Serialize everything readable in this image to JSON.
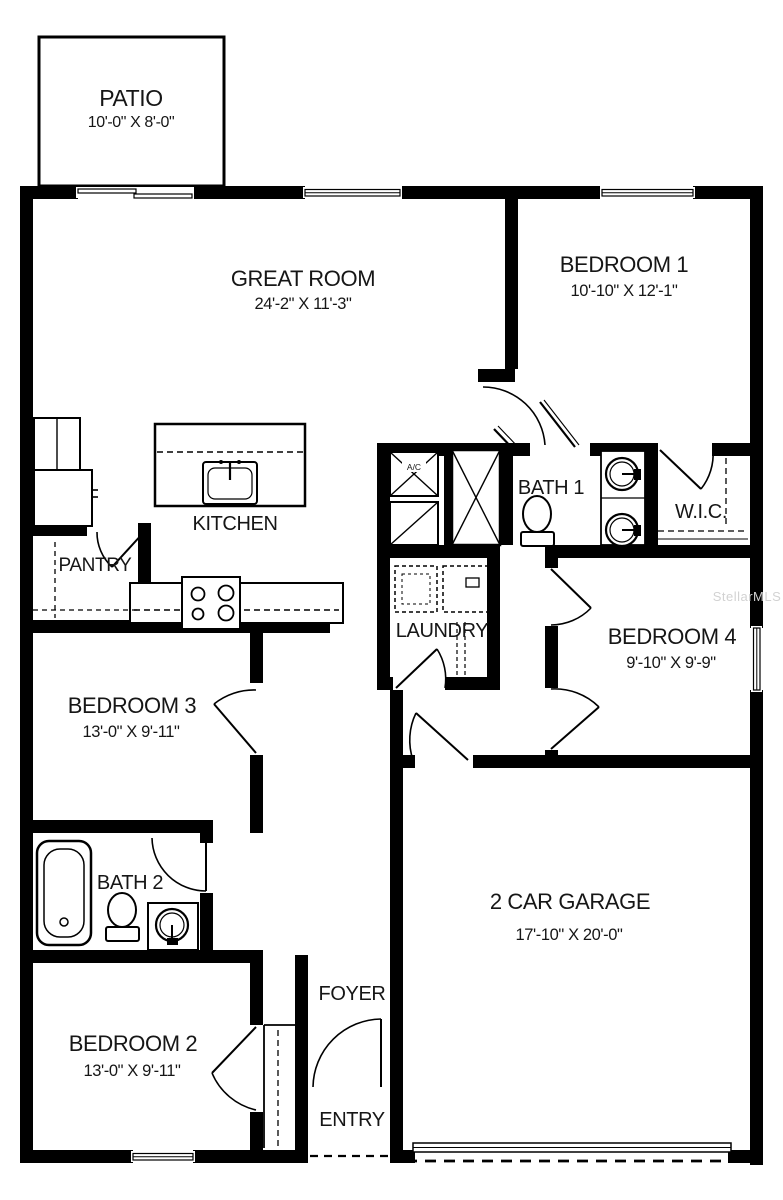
{
  "rooms": {
    "patio": {
      "name": "PATIO",
      "dims": "10'-0\" X 8'-0\""
    },
    "great_room": {
      "name": "GREAT ROOM",
      "dims": "24'-2\" X 11'-3\""
    },
    "bedroom1": {
      "name": "BEDROOM 1",
      "dims": "10'-10\" X 12'-1\""
    },
    "kitchen": {
      "name": "KITCHEN"
    },
    "pantry": {
      "name": "PANTRY"
    },
    "bath1": {
      "name": "BATH 1"
    },
    "wic": {
      "name": "W.I.C."
    },
    "laundry": {
      "name": "LAUNDRY"
    },
    "bedroom4": {
      "name": "BEDROOM 4",
      "dims": "9'-10\" X 9'-9\""
    },
    "bedroom3": {
      "name": "BEDROOM 3",
      "dims": "13'-0\" X 9'-11\""
    },
    "bath2": {
      "name": "BATH 2"
    },
    "garage": {
      "name": "2 CAR GARAGE",
      "dims": "17'-10\" X 20'-0\""
    },
    "bedroom2": {
      "name": "BEDROOM 2",
      "dims": "13'-0\" X 9'-11\""
    },
    "foyer": {
      "name": "FOYER"
    },
    "entry": {
      "name": "ENTRY"
    }
  },
  "annotations": {
    "ac_unit": "A/C",
    "watermark": "StellarMLS"
  },
  "colors": {
    "wall": "#000000",
    "background": "#ffffff",
    "watermark_gray": "#d2d2d2"
  }
}
